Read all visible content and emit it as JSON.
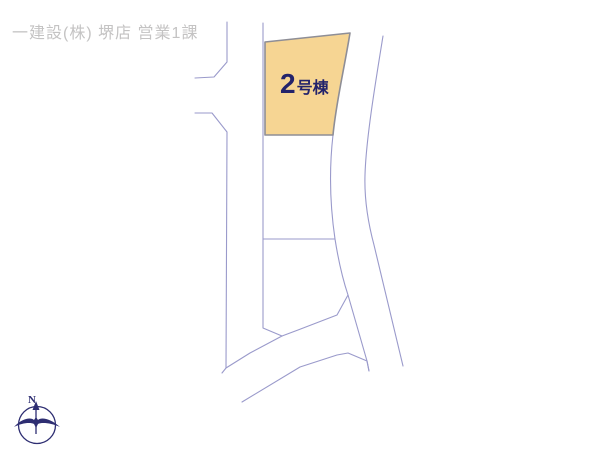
{
  "header": {
    "title": "一建設(株) 堺店 営業1課"
  },
  "map": {
    "type": "residential-site-plan",
    "highlighted_plot": {
      "number": "2",
      "suffix": "号棟",
      "full_label": "2号棟",
      "fill_color": "#f6d593",
      "border_color": "#8e8e96",
      "label_color": "#23236b"
    },
    "line_color": "#9a9acb",
    "background_color": "#ffffff"
  },
  "compass": {
    "north_label": "N",
    "color": "#2e2e72"
  }
}
